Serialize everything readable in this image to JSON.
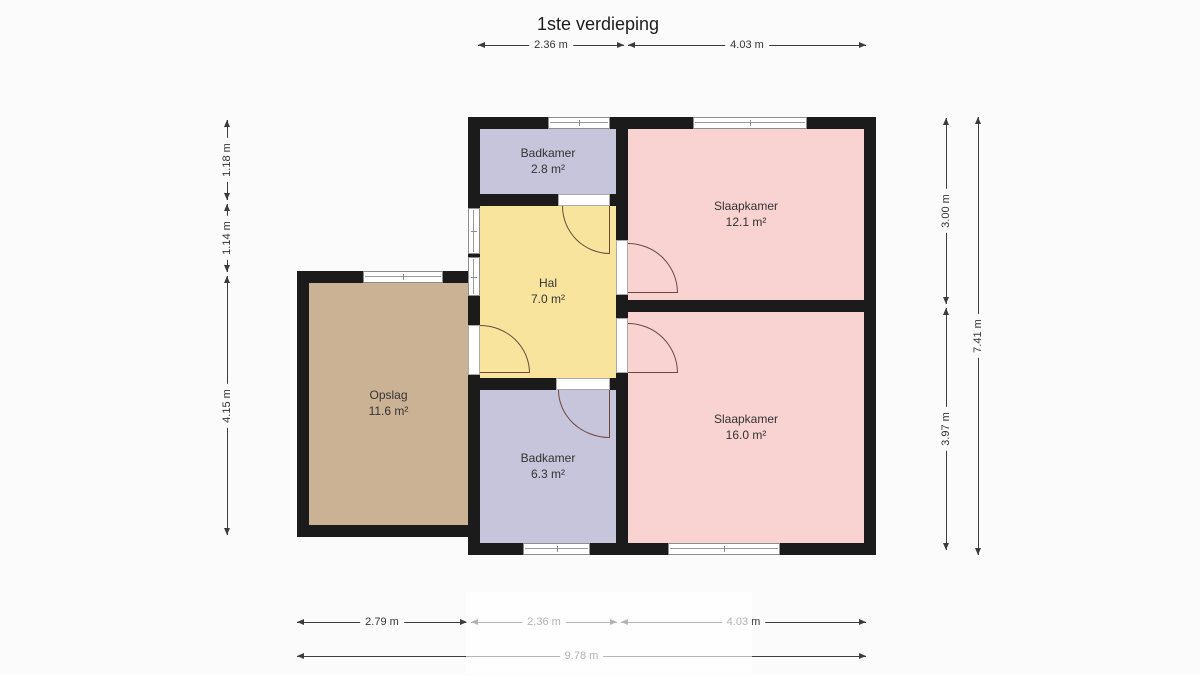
{
  "title": "1ste verdieping",
  "rooms": [
    {
      "id": "badkamer-top",
      "name": "Badkamer",
      "area": "2.8 m²"
    },
    {
      "id": "slaapkamer-top",
      "name": "Slaapkamer",
      "area": "12.1 m²"
    },
    {
      "id": "hal",
      "name": "Hal",
      "area": "7.0 m²"
    },
    {
      "id": "opslag",
      "name": "Opslag",
      "area": "11.6 m²"
    },
    {
      "id": "badkamer-bottom",
      "name": "Badkamer",
      "area": "6.3 m²"
    },
    {
      "id": "slaapkamer-bottom",
      "name": "Slaapkamer",
      "area": "16.0 m²"
    }
  ],
  "dimensions": {
    "top": [
      "2.36 m",
      "4.03 m"
    ],
    "left": [
      "1.18 m",
      "1.14 m",
      "4.15 m"
    ],
    "right": [
      "3.00 m",
      "3.97 m"
    ],
    "right_total": "7.41 m",
    "bottom": [
      "2.79 m",
      "2.36 m",
      "4.03 m"
    ],
    "bottom_total": "9.78 m"
  },
  "colors": {
    "background": "#fbfbfb",
    "wall": "#1b1b1b",
    "bathroom": "#c6c5db",
    "bedroom": "#f9d3d1",
    "hall": "#f9e49e",
    "storage": "#cbb294",
    "door_arc": "#6f473d",
    "dimension_line": "#3c3c3c"
  }
}
